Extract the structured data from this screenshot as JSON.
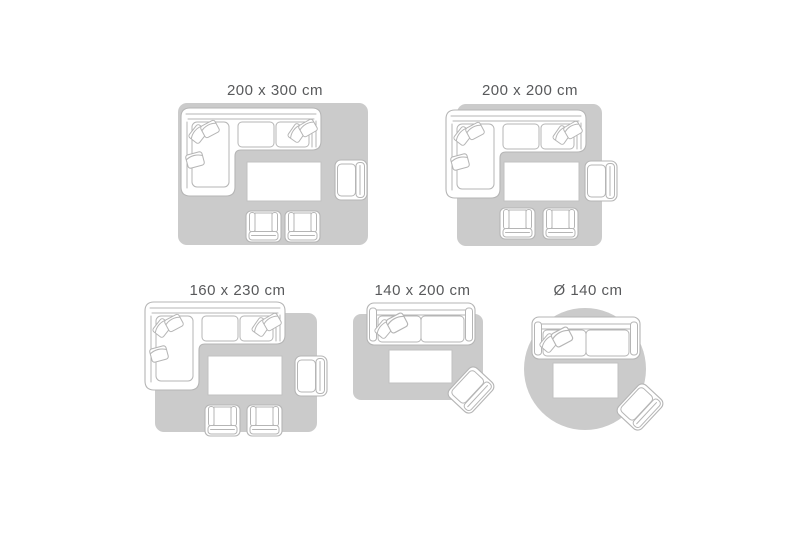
{
  "colors": {
    "background": "#ffffff",
    "rug_fill": "#cbcbcb",
    "furniture_fill": "#ffffff",
    "furniture_stroke": "#b5b5b5",
    "table_stroke": "#c2c2c2",
    "label_text": "#58595b"
  },
  "scenes": [
    {
      "label": "200 x 300 cm",
      "rug_shape": "rectangle",
      "furniture": [
        "corner-sofa",
        "coffee-table",
        "armchair",
        "small-armchair",
        "small-armchair"
      ]
    },
    {
      "label": "200 x 200 cm",
      "rug_shape": "square",
      "furniture": [
        "corner-sofa",
        "coffee-table",
        "armchair",
        "small-armchair",
        "small-armchair"
      ]
    },
    {
      "label": "160 x 230 cm",
      "rug_shape": "rectangle",
      "furniture": [
        "corner-sofa",
        "coffee-table",
        "armchair",
        "small-armchair",
        "small-armchair"
      ]
    },
    {
      "label": "140 x 200 cm",
      "rug_shape": "rectangle",
      "furniture": [
        "sofa",
        "coffee-table",
        "armchair"
      ]
    },
    {
      "label": "Ø 140 cm",
      "rug_shape": "circle",
      "furniture": [
        "sofa",
        "coffee-table",
        "armchair"
      ]
    }
  ]
}
